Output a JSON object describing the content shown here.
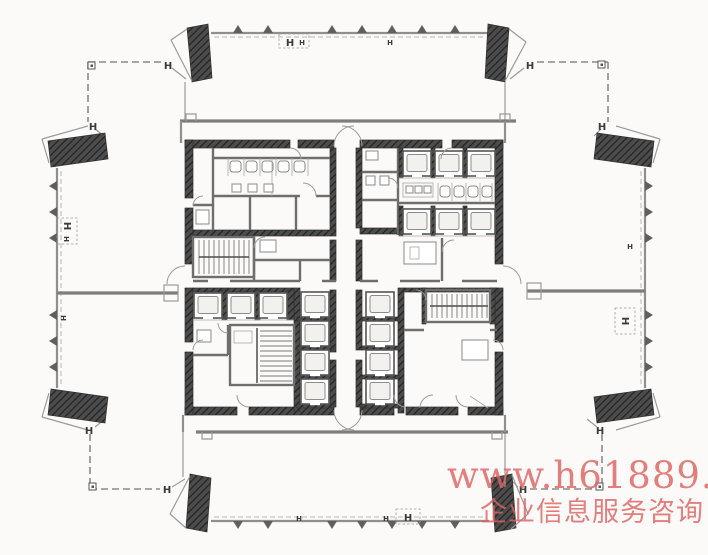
{
  "colors": {
    "paper": "#fbfaf8",
    "line_gray": "#8f8f8f",
    "wall_gray": "#7d7d7d",
    "core_dark": "#3f3f3f",
    "watermark_red": "#dd6361"
  },
  "symbols": {
    "column_mark": "H"
  },
  "watermark": {
    "line1": "www.h61889.com",
    "line2": "企业信息服务咨询"
  }
}
